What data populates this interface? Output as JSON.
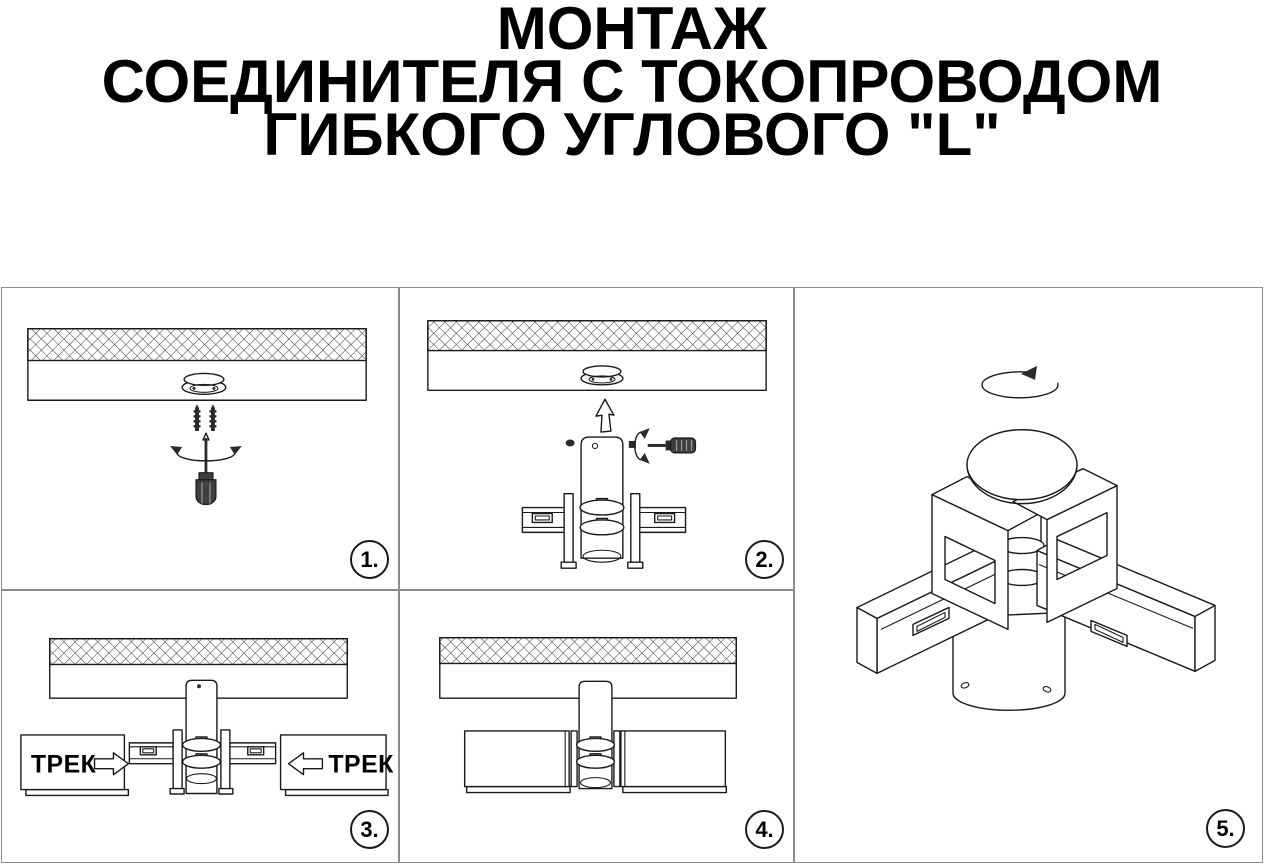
{
  "document": {
    "title_lines": [
      "МОНТАЖ",
      "СОЕДИНИТЕЛЯ С ТОКОПРОВОДОМ",
      "ГИБКОГО УГЛОВОГО \"L\""
    ]
  },
  "steps": [
    {
      "number": "1."
    },
    {
      "number": "2."
    },
    {
      "number": "3."
    },
    {
      "number": "4."
    },
    {
      "number": "5."
    }
  ],
  "panel3": {
    "track_left_label": "ТРЕК",
    "track_right_label": "ТРЕК"
  },
  "icons": {
    "rotate-arrow": "↻",
    "up-arrow": "⇧",
    "insert-right-arrow": "⇨",
    "insert-left-arrow": "⇦",
    "screwdriver": "🪛",
    "screw": "🔩"
  },
  "colors": {
    "background": "#ffffff",
    "line": "#1a1a1a",
    "panel_border": "#8c8c8c",
    "text": "#000000",
    "tool_handle": "#3f3f3f"
  }
}
